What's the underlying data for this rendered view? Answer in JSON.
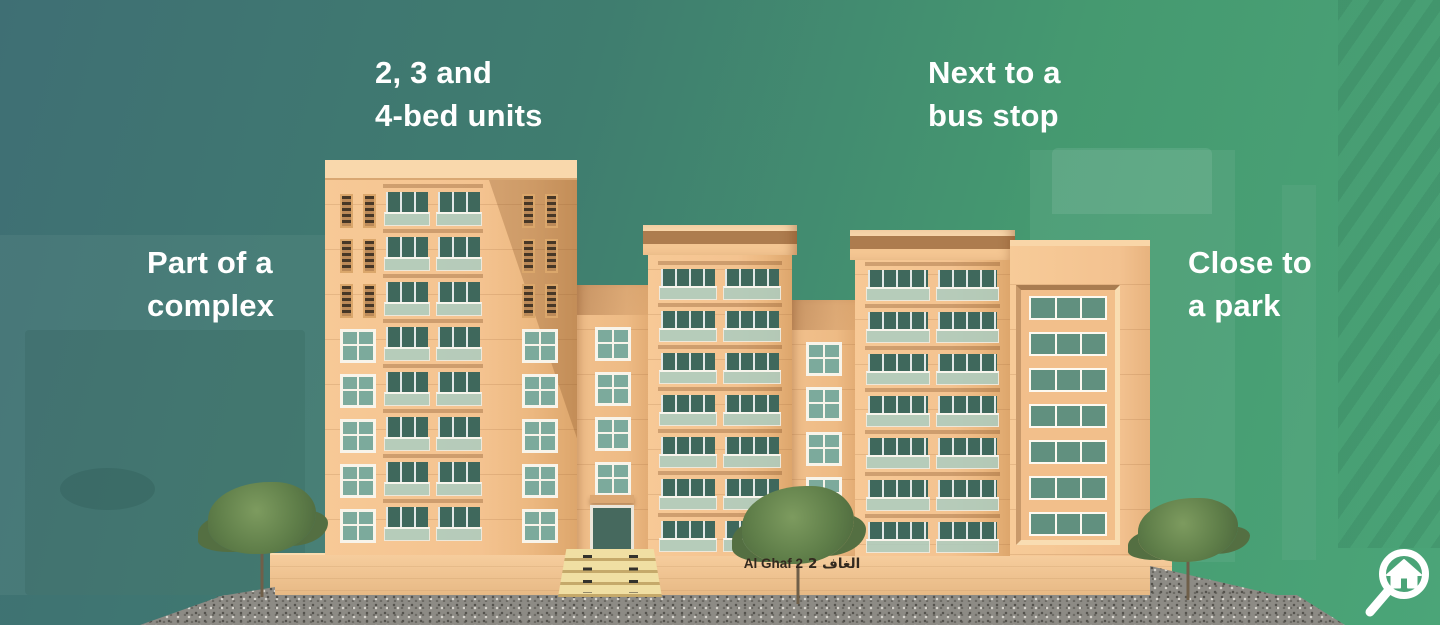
{
  "title": "Al Ghaf 2 property highlights infographic",
  "features": [
    {
      "id": "bed-units",
      "text": "2, 3 and\n4-bed units"
    },
    {
      "id": "bus-stop",
      "text": "Next to a\nbus stop"
    },
    {
      "id": "complex",
      "text": "Part of a\ncomplex"
    },
    {
      "id": "park",
      "text": "Close to\na park"
    }
  ],
  "building": {
    "name_en": "Al Ghaf 2",
    "name_ar": "الغاف 2"
  },
  "logo": {
    "icon": "magnifier-house-logo"
  },
  "colors": {
    "background_teal": "#3f6f74",
    "background_green": "#4ba578",
    "facade_peach": "#f5c795",
    "facade_shadow": "#dda66c",
    "window_glass_dark": "#3f685c",
    "window_glass_light": "#7caa9c",
    "window_frame": "#f8f4ea",
    "gravel_gray": "#8d8b85",
    "stairs_sand": "#f0dfa3",
    "label_text": "#ffffff",
    "building_label_text": "#33291f",
    "tree_green": "#5f7e49"
  }
}
